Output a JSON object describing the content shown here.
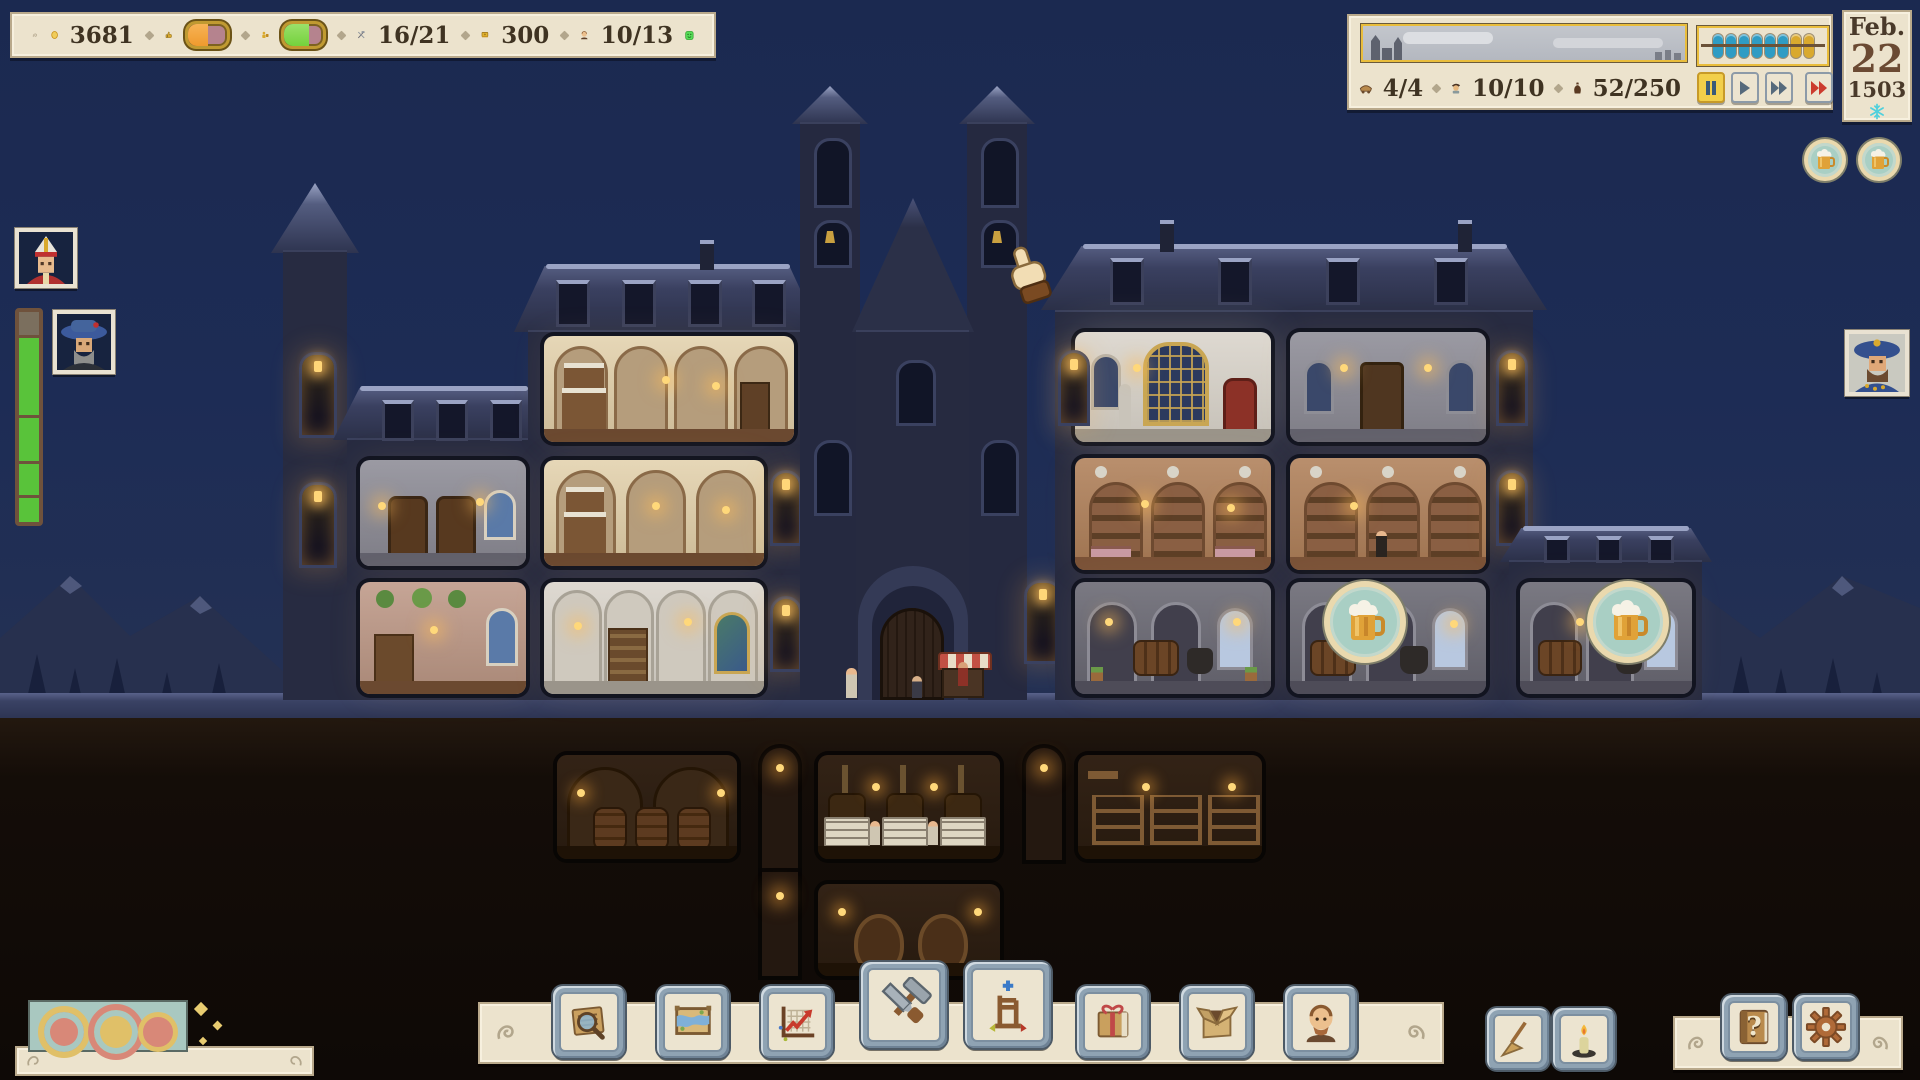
{
  "meta": {
    "scene": "monastery-brewery-cross-section-night",
    "season": "winter"
  },
  "colors": {
    "parchment": "#ece3cd",
    "ink": "#3f3322",
    "accent_gold": "#e9bd3c",
    "sky": "#1d2c55",
    "bar_track": "#b5838e",
    "bar_orange": "#ef9a2e",
    "bar_green": "#74d23c",
    "bead_blue": "#2f9cc4",
    "bead_gold": "#d9a92e",
    "snowflake": "#4fd0dc",
    "alert_red": "#cc3b2e"
  },
  "resources_bar": {
    "gold": "3681",
    "reputation": {
      "icon": "thumbs-up-icon",
      "fill_pct": 52
    },
    "workers": {
      "icon": "worker-icon",
      "fill_pct": 62
    },
    "tools": "16/21",
    "books": "300",
    "monks": "10/13",
    "happiness_icon": "happy-face-icon"
  },
  "town_panel": {
    "wagons": "4/4",
    "villagers": "10/10",
    "storage": "52/250",
    "abacus": {
      "blue_beads": 6,
      "gold_beads": 2
    },
    "speed_controls": {
      "buttons": [
        "pause",
        "play",
        "fast-forward",
        "max-speed"
      ],
      "active": "pause"
    }
  },
  "calendar": {
    "month": "Feb.",
    "day": "22",
    "year": "1503",
    "season_icon": "snowflake-icon"
  },
  "left_hud": {
    "portraits": [
      "bishop",
      "noble-blue-hat"
    ],
    "gauge": {
      "segments": 4,
      "empty_top_pct": 11,
      "color": "#59c33a"
    }
  },
  "right_hud": {
    "beer_tokens": 2,
    "portrait": "noble-blue-beret"
  },
  "building_overlays": {
    "brewing_badges": [
      {
        "room": "cellar-2",
        "icon": "beer-mug"
      },
      {
        "room": "cellar-3",
        "icon": "beer-mug"
      }
    ]
  },
  "toolbar": {
    "buttons": [
      "ledger-search",
      "world-map",
      "statistics-chart",
      "construction-tools",
      "furniture-chair",
      "wrapped-package",
      "open-box",
      "monk-roster"
    ],
    "elevated": [
      "construction-tools",
      "furniture-chair"
    ]
  },
  "utility_buttons": [
    "broom",
    "candle"
  ],
  "system_buttons": {
    "help": "help-book",
    "help_glyph": "?",
    "settings": "settings-gear"
  },
  "notification": {
    "icon": "celebration-splash"
  }
}
